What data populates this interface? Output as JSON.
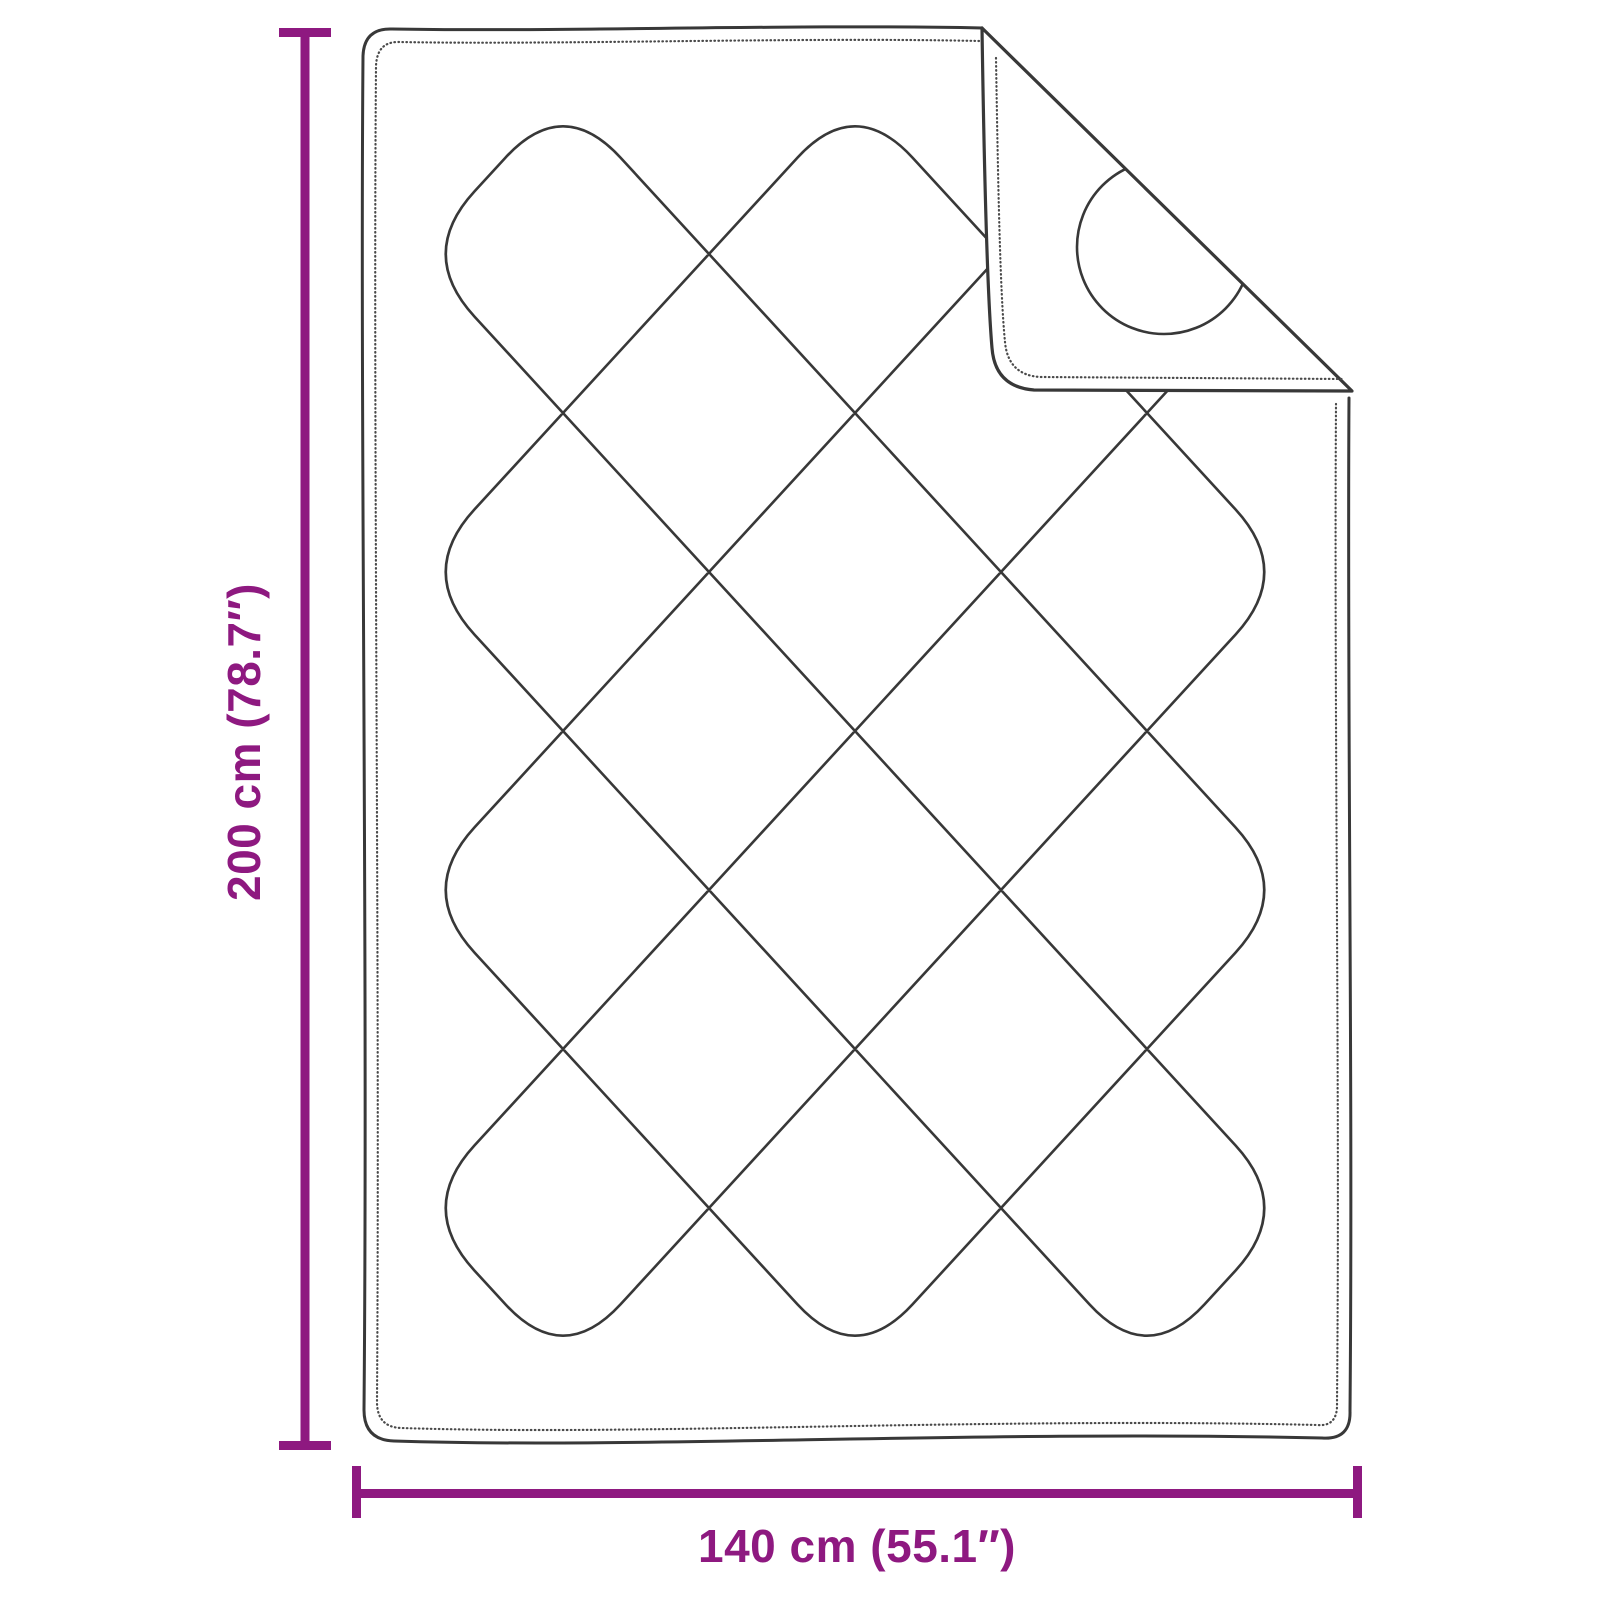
{
  "diagram": {
    "type": "product-dimension-diagram",
    "subject": "quilted-blanket-with-folded-corner"
  },
  "dimensions": {
    "height": {
      "label": "200 cm (78.7″)",
      "value_cm": 200,
      "value_inch": 78.7
    },
    "width": {
      "label": "140 cm (55.1″)",
      "value_cm": 140,
      "value_inch": 55.1
    }
  },
  "style": {
    "dimension_color": "#8E1980",
    "line_color": "#383838",
    "stitch_color": "#4a4a4a",
    "background": "#ffffff"
  }
}
